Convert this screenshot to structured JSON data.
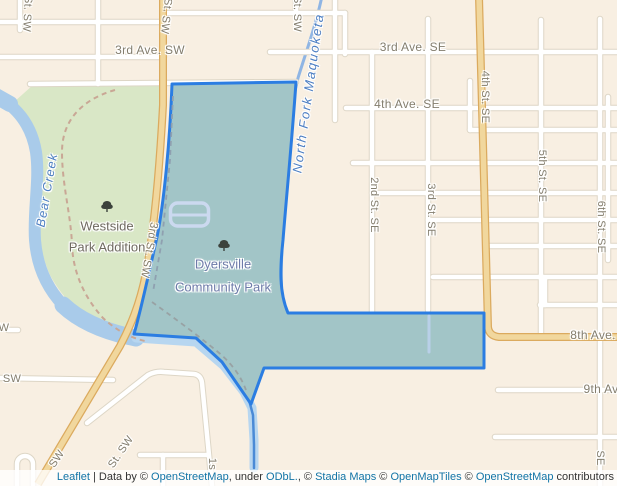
{
  "map": {
    "colors": {
      "background": "#f8efe2",
      "park_green": "#d9e7c6",
      "water": "#a9cbea",
      "highlight_fill": "#a2c5c7",
      "highlight_border": "#2b7de2",
      "road_orange": "#f1d79d",
      "road_orange_casing": "#dbaa5e",
      "road_white": "#ffffff",
      "street_text": "#837d6d",
      "water_text": "#4c7ec2",
      "link_blue": "#1274a6"
    },
    "labels": [
      {
        "name": "street-label-st-sw-topleft",
        "kind": "lb-street",
        "text": "St. SW",
        "x": 27,
        "y": 14,
        "rot": 93
      },
      {
        "name": "street-label-3rd-st-sw-top",
        "kind": "lb-street",
        "text": "St. SW",
        "x": 166,
        "y": 16,
        "rot": 96
      },
      {
        "name": "street-label-st-sw-top-2",
        "kind": "lb-street",
        "text": "St. SW",
        "x": 297,
        "y": 14,
        "rot": 90
      },
      {
        "name": "street-label-3rd-ave-sw",
        "kind": "lb-street-lg",
        "text": "3rd Ave. SW",
        "x": 150,
        "y": 50,
        "rot": 0
      },
      {
        "name": "street-label-3rd-ave-se",
        "kind": "lb-street-lg",
        "text": "3rd Ave. SE",
        "x": 413,
        "y": 47,
        "rot": 0
      },
      {
        "name": "street-label-4th-ave-se",
        "kind": "lb-street-lg",
        "text": "4th Ave. SE",
        "x": 407,
        "y": 104,
        "rot": 0
      },
      {
        "name": "street-label-2nd-st-se",
        "kind": "lb-street",
        "text": "2nd St. SE",
        "x": 374,
        "y": 205,
        "rot": 90
      },
      {
        "name": "street-label-3rd-st-se",
        "kind": "lb-street",
        "text": "3rd St. SE",
        "x": 431,
        "y": 210,
        "rot": 90
      },
      {
        "name": "street-label-4th-st-se",
        "kind": "lb-street",
        "text": "4th St. SE",
        "x": 485,
        "y": 97,
        "rot": 90
      },
      {
        "name": "street-label-5th-st-se",
        "kind": "lb-street",
        "text": "5th St. SE",
        "x": 542,
        "y": 176,
        "rot": 90
      },
      {
        "name": "street-label-6th-st-se",
        "kind": "lb-street",
        "text": "6th St. SE",
        "x": 601,
        "y": 227,
        "rot": 90
      },
      {
        "name": "street-label-3rd-st-sw",
        "kind": "lb-street",
        "text": "3rd St. SW",
        "x": 149,
        "y": 250,
        "rot": 100
      },
      {
        "name": "street-label-8th-ave",
        "kind": "lb-street-lg",
        "text": "8th Ave.",
        "x": 593,
        "y": 335,
        "rot": 0
      },
      {
        "name": "street-label-9th-ave",
        "kind": "lb-street-lg",
        "text": "9th Av",
        "x": 601,
        "y": 389,
        "rot": 0
      },
      {
        "name": "street-label-se-bottom",
        "kind": "lb-street",
        "text": "SE",
        "x": 600,
        "y": 458,
        "rot": 90
      },
      {
        "name": "street-label-sw-highway",
        "kind": "lb-street",
        "text": "SW",
        "x": 57,
        "y": 459,
        "rot": -56
      },
      {
        "name": "street-label-st-sw-diag",
        "kind": "lb-street",
        "text": "St. SW",
        "x": 121,
        "y": 452,
        "rot": -56
      },
      {
        "name": "street-label-1st-st-sw",
        "kind": "lb-street",
        "text": "1s",
        "x": 212,
        "y": 464,
        "rot": 90
      },
      {
        "name": "street-label-w-partial",
        "kind": "lb-street",
        "text": "W",
        "x": 4,
        "y": 328,
        "rot": 0
      },
      {
        "name": "street-label-sw-partial",
        "kind": "lb-street",
        "text": "SW",
        "x": 12,
        "y": 379,
        "rot": 0
      },
      {
        "name": "place-label-westside-1",
        "kind": "lb-place",
        "text": "Westside",
        "x": 107,
        "y": 226,
        "rot": 0
      },
      {
        "name": "place-label-westside-2",
        "kind": "lb-place",
        "text": "Park Addition",
        "x": 107,
        "y": 247,
        "rot": 0
      },
      {
        "name": "place-label-dyersville-1",
        "kind": "lb-place-blue",
        "text": "Dyersville",
        "x": 223,
        "y": 264,
        "rot": 0
      },
      {
        "name": "place-label-dyersville-2",
        "kind": "lb-place-blue",
        "text": "Community Park",
        "x": 223,
        "y": 287,
        "rot": 0
      },
      {
        "name": "water-label-bear-creek",
        "kind": "lb-water-sm",
        "text": "Bear Creek",
        "x": 47,
        "y": 190,
        "rot": -80
      },
      {
        "name": "water-label-north-fork-maquoketa",
        "kind": "lb-water",
        "text": "North Fork Maquoketa",
        "x": 308,
        "y": 93,
        "rot": -82
      }
    ],
    "trees": [
      {
        "name": "tree-icon-westside",
        "x": 107,
        "y": 207
      },
      {
        "name": "tree-icon-dyersville",
        "x": 224,
        "y": 246
      }
    ],
    "attribution": {
      "leaflet_link": "Leaflet",
      "data_by": " | Data by © ",
      "osm_link_1": "OpenStreetMap",
      "under": ", under ",
      "odbl_link": "ODbL.",
      "comma_c": ", © ",
      "stadia_link": "Stadia Maps",
      "c1": " © ",
      "openmaptiles_link": "OpenMapTiles",
      "c2": " © ",
      "osm_link_2": "OpenStreetMap",
      "contributors": " contributors"
    }
  }
}
